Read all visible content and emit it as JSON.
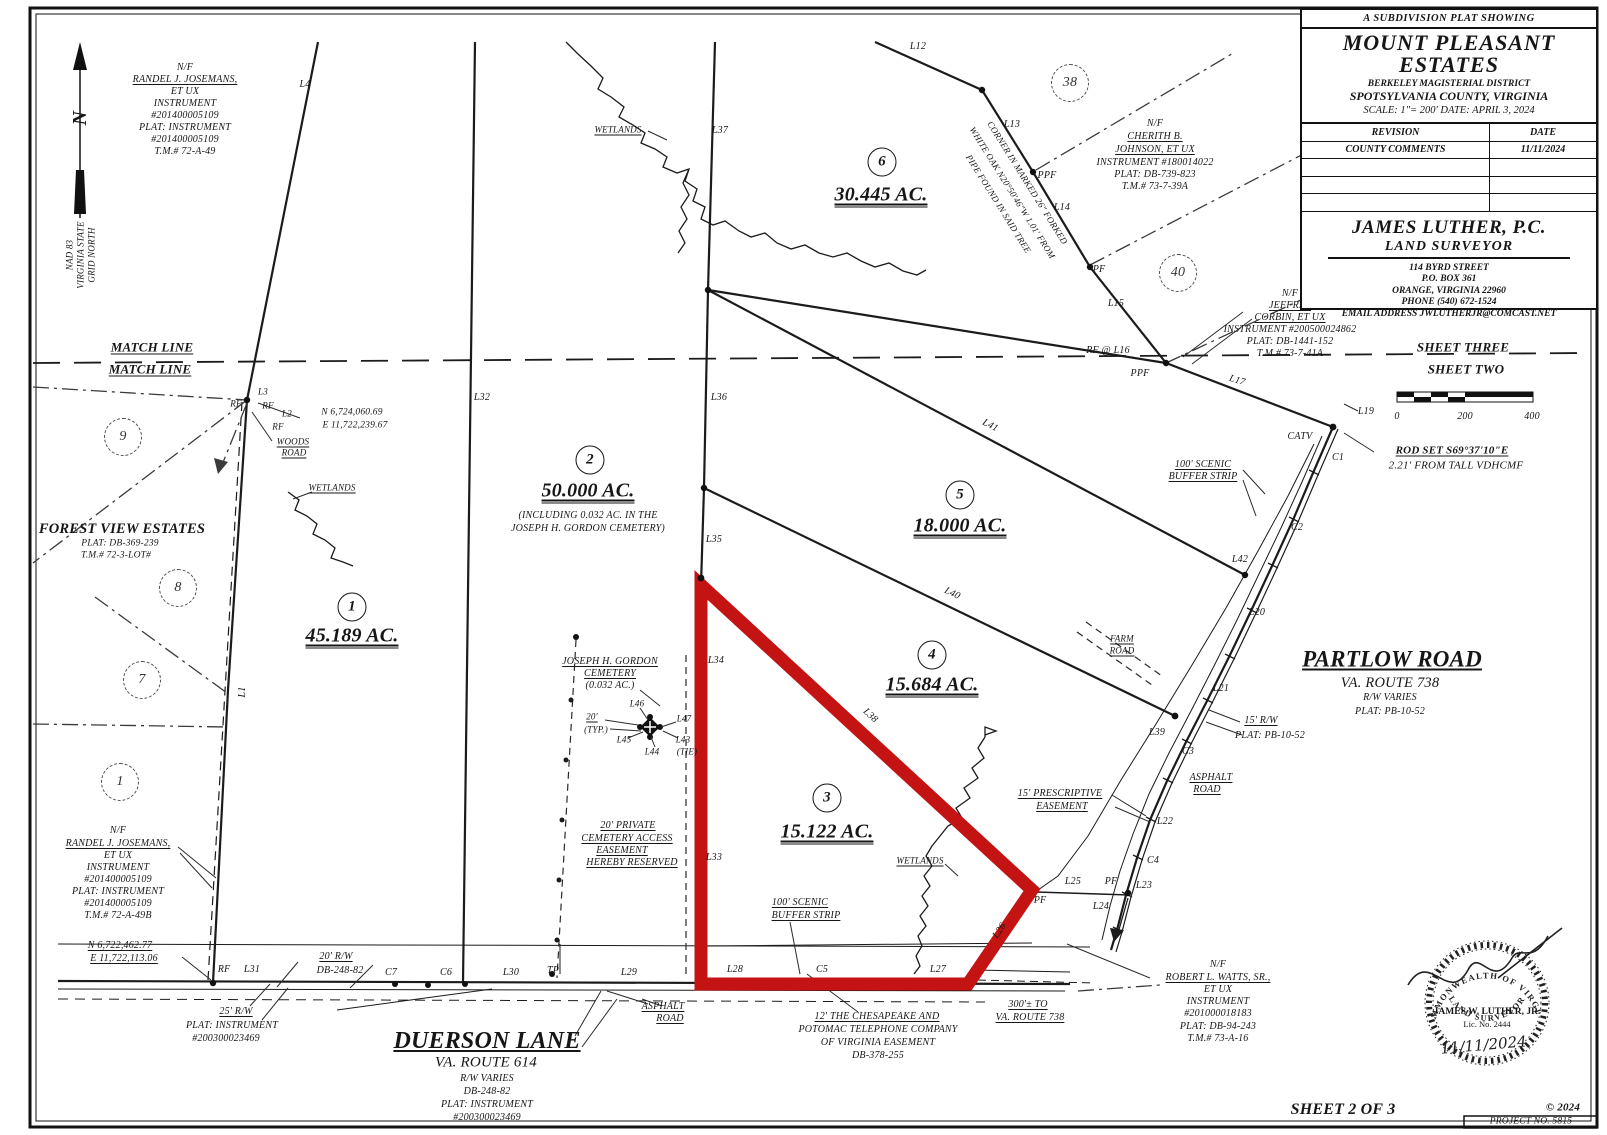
{
  "title_block": {
    "kicker": "A SUBDIVISION PLAT SHOWING",
    "title_line1": "MOUNT PLEASANT",
    "title_line2": "ESTATES",
    "district": "BERKELEY MAGISTERIAL DISTRICT",
    "county": "SPOTSYLVANIA COUNTY, VIRGINIA",
    "scale_date": "SCALE: 1\"= 200'  DATE: APRIL 3, 2024"
  },
  "revision_table": {
    "headers": [
      "REVISION",
      "DATE"
    ],
    "rows": [
      [
        "COUNTY COMMENTS",
        "11/11/2024"
      ],
      [
        "",
        ""
      ],
      [
        "",
        ""
      ],
      [
        "",
        ""
      ]
    ]
  },
  "surveyor_block": {
    "name": "JAMES LUTHER, P.C.",
    "role": "LAND SURVEYOR",
    "address1": "114 BYRD STREET",
    "address2": "P.O. BOX 361",
    "address3": "ORANGE, VIRGINIA 22960",
    "address4": "PHONE (540) 672-1524",
    "email": "EMAIL ADDRESS  JWLUTHERJR@COMCAST.NET"
  },
  "seal": {
    "arc_top": "COMMONWEALTH OF VIRGINIA",
    "name": "JAMES W. LUTHER, JR.",
    "license": "Lic. No. 2444",
    "date": "11/11/2024",
    "arc_bottom": "LAND SURVEYOR"
  },
  "north_arrow": {
    "letter": "N",
    "datum_lines": [
      "NAD 83",
      "VIRGINIA STATE",
      "GRID NORTH"
    ]
  },
  "scale_bar": {
    "tick_labels": [
      "0",
      "200",
      "400"
    ]
  },
  "footer": {
    "sheet": "SHEET 2 OF 3",
    "copyright": "© 2024",
    "project": "PROJECT NO. 5815"
  },
  "colors": {
    "highlight_red": "#c31313",
    "ink": "#1b1b1b",
    "paper": "#ffffff"
  },
  "labels": [
    {
      "t": "N/F",
      "x": 185,
      "y": 68
    },
    {
      "t": "RANDEL J. JOSEMANS,",
      "x": 185,
      "y": 80,
      "c": "u",
      "n": "adjoiner-owner-label"
    },
    {
      "t": "ET UX",
      "x": 185,
      "y": 92
    },
    {
      "t": "INSTRUMENT",
      "x": 185,
      "y": 104
    },
    {
      "t": "#201400005109",
      "x": 185,
      "y": 116
    },
    {
      "t": "PLAT: INSTRUMENT",
      "x": 185,
      "y": 128
    },
    {
      "t": "#201400005109",
      "x": 185,
      "y": 140
    },
    {
      "t": "T.M.# 72-A-49",
      "x": 185,
      "y": 152
    },
    {
      "t": "L4",
      "x": 305,
      "y": 85
    },
    {
      "t": "N",
      "x": 80,
      "y": 118,
      "s": 20,
      "r": -90,
      "c": "b",
      "n": "north-letter"
    },
    {
      "t": "NAD 83",
      "x": 70,
      "y": 255,
      "s": 9,
      "r": -90,
      "n": "datum-label"
    },
    {
      "t": "VIRGINIA STATE",
      "x": 81,
      "y": 255,
      "s": 9,
      "r": -90
    },
    {
      "t": "GRID NORTH",
      "x": 92,
      "y": 255,
      "s": 9,
      "r": -90
    },
    {
      "t": "MATCH LINE",
      "x": 152,
      "y": 347,
      "s": 13,
      "c": "b u",
      "n": "match-line-label"
    },
    {
      "t": "MATCH LINE",
      "x": 150,
      "y": 369,
      "s": 13,
      "c": "b u"
    },
    {
      "t": "SHEET THREE",
      "x": 1463,
      "y": 347,
      "s": 13,
      "c": "b",
      "n": "sheet-three-label"
    },
    {
      "t": "SHEET TWO",
      "x": 1466,
      "y": 369,
      "s": 13,
      "c": "b",
      "n": "sheet-two-label"
    },
    {
      "t": "L3",
      "x": 263,
      "y": 392,
      "s": 9
    },
    {
      "t": "RF",
      "x": 236,
      "y": 404,
      "s": 9
    },
    {
      "t": "RF",
      "x": 268,
      "y": 406,
      "s": 9
    },
    {
      "t": "L2",
      "x": 287,
      "y": 414,
      "s": 9
    },
    {
      "t": "N 6,724,060.69",
      "x": 352,
      "y": 413,
      "s": 9.5,
      "n": "coordinate-label"
    },
    {
      "t": "RF",
      "x": 278,
      "y": 427,
      "s": 9
    },
    {
      "t": "E 11,722,239.67",
      "x": 355,
      "y": 426,
      "s": 9.5
    },
    {
      "t": "WOODS",
      "x": 293,
      "y": 442,
      "s": 9,
      "c": "u"
    },
    {
      "t": "ROAD",
      "x": 294,
      "y": 453,
      "s": 9,
      "c": "u"
    },
    {
      "t": "WETLANDS",
      "x": 332,
      "y": 488,
      "s": 9,
      "c": "u",
      "n": "wetlands-label"
    },
    {
      "t": "FOREST VIEW ESTATES",
      "x": 122,
      "y": 529,
      "s": 14.5,
      "c": "b",
      "n": "adjacent-subdivision-label"
    },
    {
      "t": "PLAT: DB-369-239",
      "x": 120,
      "y": 544,
      "s": 9.5
    },
    {
      "t": "T.M.# 72-3-LOT#",
      "x": 116,
      "y": 556,
      "s": 9.5
    },
    {
      "t": "9",
      "x": 123,
      "y": 437,
      "c": "dcirc",
      "n": "adjacent-lot-number"
    },
    {
      "t": "8",
      "x": 178,
      "y": 588,
      "c": "dcirc",
      "n": "adjacent-lot-number"
    },
    {
      "t": "7",
      "x": 142,
      "y": 680,
      "c": "dcirc",
      "n": "adjacent-lot-number"
    },
    {
      "t": "1",
      "x": 120,
      "y": 782,
      "c": "dcirc",
      "n": "adjacent-lot-number"
    },
    {
      "t": "38",
      "x": 1070,
      "y": 83,
      "c": "dcirc",
      "n": "adjacent-lot-number"
    },
    {
      "t": "40",
      "x": 1178,
      "y": 273,
      "c": "dcirc",
      "n": "adjacent-lot-number"
    },
    {
      "t": "1",
      "x": 352,
      "y": 607,
      "c": "circ",
      "n": "parcel-1-number"
    },
    {
      "t": "45.189 AC.",
      "x": 352,
      "y": 637,
      "s": 20,
      "c": "b uu",
      "n": "parcel-1-acreage"
    },
    {
      "t": "2",
      "x": 590,
      "y": 460,
      "c": "circ",
      "n": "parcel-2-number"
    },
    {
      "t": "50.000 AC.",
      "x": 588,
      "y": 492,
      "s": 20,
      "c": "b uu",
      "n": "parcel-2-acreage"
    },
    {
      "t": "(INCLUDING 0.032 AC. IN THE",
      "x": 588,
      "y": 516
    },
    {
      "t": "JOSEPH H. GORDON CEMETERY)",
      "x": 588,
      "y": 529
    },
    {
      "t": "3",
      "x": 827,
      "y": 798,
      "c": "circ",
      "n": "parcel-3-number"
    },
    {
      "t": "15.122 AC.",
      "x": 827,
      "y": 833,
      "s": 20,
      "c": "b uu",
      "n": "parcel-3-acreage"
    },
    {
      "t": "4",
      "x": 932,
      "y": 655,
      "c": "circ",
      "n": "parcel-4-number"
    },
    {
      "t": "15.684 AC.",
      "x": 932,
      "y": 686,
      "s": 20,
      "c": "b uu",
      "n": "parcel-4-acreage"
    },
    {
      "t": "5",
      "x": 960,
      "y": 495,
      "c": "circ",
      "n": "parcel-5-number"
    },
    {
      "t": "18.000 AC.",
      "x": 960,
      "y": 527,
      "s": 20,
      "c": "b uu",
      "n": "parcel-5-acreage"
    },
    {
      "t": "6",
      "x": 882,
      "y": 162,
      "c": "circ",
      "n": "parcel-6-number"
    },
    {
      "t": "30.445 AC.",
      "x": 881,
      "y": 196,
      "s": 20,
      "c": "b uu",
      "n": "parcel-6-acreage"
    },
    {
      "t": "L32",
      "x": 482,
      "y": 398
    },
    {
      "t": "L36",
      "x": 719,
      "y": 398
    },
    {
      "t": "L37",
      "x": 720,
      "y": 131
    },
    {
      "t": "L35",
      "x": 714,
      "y": 540
    },
    {
      "t": "L34",
      "x": 716,
      "y": 661
    },
    {
      "t": "L33",
      "x": 714,
      "y": 858
    },
    {
      "t": "L12",
      "x": 918,
      "y": 47
    },
    {
      "t": "L13",
      "x": 1012,
      "y": 125
    },
    {
      "t": "PPF",
      "x": 1047,
      "y": 176
    },
    {
      "t": "L14",
      "x": 1062,
      "y": 208
    },
    {
      "t": "PF",
      "x": 1099,
      "y": 270
    },
    {
      "t": "L15",
      "x": 1116,
      "y": 304
    },
    {
      "t": "RF @ L16",
      "x": 1108,
      "y": 351
    },
    {
      "t": "PPF",
      "x": 1140,
      "y": 374
    },
    {
      "t": "L17",
      "x": 1237,
      "y": 381,
      "r": 17
    },
    {
      "t": "L19",
      "x": 1366,
      "y": 412
    },
    {
      "t": "CATV",
      "x": 1300,
      "y": 437
    },
    {
      "t": "C1",
      "x": 1338,
      "y": 458
    },
    {
      "t": "ROD SET S69°37'10\"E",
      "x": 1452,
      "y": 451,
      "s": 11,
      "c": "b u"
    },
    {
      "t": "2.21' FROM TALL VDHCMF",
      "x": 1456,
      "y": 466,
      "s": 11
    },
    {
      "t": "100' SCENIC",
      "x": 1203,
      "y": 465,
      "c": "u",
      "n": "scenic-buffer-label"
    },
    {
      "t": "BUFFER STRIP",
      "x": 1203,
      "y": 477,
      "c": "u"
    },
    {
      "t": "C2",
      "x": 1297,
      "y": 528
    },
    {
      "t": "L42",
      "x": 1240,
      "y": 560
    },
    {
      "t": "L20",
      "x": 1257,
      "y": 613
    },
    {
      "t": "FARM",
      "x": 1122,
      "y": 639,
      "s": 9,
      "c": "u"
    },
    {
      "t": "ROAD",
      "x": 1122,
      "y": 651,
      "s": 9,
      "c": "u"
    },
    {
      "t": "PARTLOW ROAD",
      "x": 1392,
      "y": 659,
      "s": 23,
      "c": "b u",
      "n": "partlow-road-label"
    },
    {
      "t": "VA. ROUTE 738",
      "x": 1390,
      "y": 683,
      "s": 14.5
    },
    {
      "t": "R/W VARIES",
      "x": 1390,
      "y": 698
    },
    {
      "t": "PLAT: PB-10-52",
      "x": 1390,
      "y": 712
    },
    {
      "t": "L21",
      "x": 1221,
      "y": 689
    },
    {
      "t": "15' R/W",
      "x": 1261,
      "y": 721,
      "c": "u"
    },
    {
      "t": "PLAT: PB-10-52",
      "x": 1270,
      "y": 736
    },
    {
      "t": "L39",
      "x": 1157,
      "y": 733
    },
    {
      "t": "C3",
      "x": 1188,
      "y": 752
    },
    {
      "t": "ASPHALT",
      "x": 1211,
      "y": 778,
      "c": "u"
    },
    {
      "t": "ROAD",
      "x": 1207,
      "y": 790,
      "c": "u"
    },
    {
      "t": "15' PRESCRIPTIVE",
      "x": 1060,
      "y": 794,
      "c": "u",
      "n": "prescriptive-easement-label"
    },
    {
      "t": "EASEMENT",
      "x": 1062,
      "y": 807,
      "c": "u"
    },
    {
      "t": "L22",
      "x": 1165,
      "y": 822
    },
    {
      "t": "C4",
      "x": 1153,
      "y": 861
    },
    {
      "t": "L25",
      "x": 1073,
      "y": 882
    },
    {
      "t": "PF",
      "x": 1111,
      "y": 882
    },
    {
      "t": "L23",
      "x": 1144,
      "y": 886
    },
    {
      "t": "L24",
      "x": 1101,
      "y": 907
    },
    {
      "t": "PF",
      "x": 1040,
      "y": 901
    },
    {
      "t": "WETLANDS",
      "x": 920,
      "y": 861,
      "s": 9,
      "c": "u",
      "n": "wetlands-label"
    },
    {
      "t": "100' SCENIC",
      "x": 800,
      "y": 903,
      "c": "u",
      "n": "scenic-buffer-label"
    },
    {
      "t": "BUFFER STRIP",
      "x": 806,
      "y": 916,
      "c": "u"
    },
    {
      "t": "L38",
      "x": 870,
      "y": 716,
      "r": 43
    },
    {
      "t": "L40",
      "x": 952,
      "y": 594,
      "r": 26
    },
    {
      "t": "L41",
      "x": 990,
      "y": 426,
      "r": 28
    },
    {
      "t": "L26",
      "x": 1000,
      "y": 931,
      "r": -56
    },
    {
      "t": "L1",
      "x": 243,
      "y": 692,
      "r": -90
    },
    {
      "t": "JOSEPH H. GORDON",
      "x": 610,
      "y": 662,
      "c": "u",
      "n": "cemetery-label"
    },
    {
      "t": "CEMETERY",
      "x": 610,
      "y": 674,
      "c": "u"
    },
    {
      "t": "(0.032 AC.)",
      "x": 610,
      "y": 686
    },
    {
      "t": "L46",
      "x": 637,
      "y": 704,
      "s": 9
    },
    {
      "t": "20'",
      "x": 592,
      "y": 717,
      "s": 9,
      "c": "u"
    },
    {
      "t": "(TYP.)",
      "x": 596,
      "y": 730,
      "s": 9
    },
    {
      "t": "L47",
      "x": 684,
      "y": 719,
      "s": 9
    },
    {
      "t": "L45",
      "x": 624,
      "y": 740,
      "s": 9
    },
    {
      "t": "L44",
      "x": 652,
      "y": 752,
      "s": 9
    },
    {
      "t": "L43",
      "x": 683,
      "y": 740,
      "s": 9
    },
    {
      "t": "(TIE)",
      "x": 687,
      "y": 752,
      "s": 9
    },
    {
      "t": "20' PRIVATE",
      "x": 628,
      "y": 826,
      "c": "u",
      "n": "cemetery-easement-note"
    },
    {
      "t": "CEMETERY ACCESS",
      "x": 627,
      "y": 839,
      "c": "u"
    },
    {
      "t": "EASEMENT",
      "x": 622,
      "y": 851,
      "c": "u"
    },
    {
      "t": "HEREBY RESERVED",
      "x": 632,
      "y": 863,
      "c": "u"
    },
    {
      "t": "WETLANDS",
      "x": 618,
      "y": 130,
      "s": 9,
      "c": "u",
      "n": "wetlands-label"
    },
    {
      "t": "CORNER IN MARKED 26\" FORKED",
      "x": 1027,
      "y": 183,
      "s": 9,
      "r": 58,
      "n": "corner-note"
    },
    {
      "t": "WHITE OAK N20°50'46\"W 1.01' FROM",
      "x": 1012,
      "y": 193,
      "s": 9,
      "r": 58
    },
    {
      "t": "PIPE FOUND IN SAID TREE",
      "x": 998,
      "y": 204,
      "s": 9,
      "r": 58
    },
    {
      "t": "N/F",
      "x": 1155,
      "y": 124
    },
    {
      "t": "CHERITH B.",
      "x": 1155,
      "y": 137,
      "c": "u",
      "n": "adjoiner-owner-label"
    },
    {
      "t": "JOHNSON, ET UX",
      "x": 1155,
      "y": 150,
      "c": "u"
    },
    {
      "t": "INSTRUMENT #180014022",
      "x": 1155,
      "y": 163
    },
    {
      "t": "PLAT: DB-739-823",
      "x": 1155,
      "y": 175
    },
    {
      "t": "T.M.# 73-7-39A",
      "x": 1155,
      "y": 187
    },
    {
      "t": "N/F",
      "x": 1290,
      "y": 294
    },
    {
      "t": "JEFFREY",
      "x": 1290,
      "y": 306,
      "c": "u",
      "n": "adjoiner-owner-label"
    },
    {
      "t": "CORBIN, ET UX",
      "x": 1290,
      "y": 318,
      "c": "u"
    },
    {
      "t": "INSTRUMENT #200500024862",
      "x": 1290,
      "y": 330
    },
    {
      "t": "PLAT: DB-1441-152",
      "x": 1290,
      "y": 342
    },
    {
      "t": "T.M.# 73-7-41A",
      "x": 1290,
      "y": 354
    },
    {
      "t": "RF",
      "x": 224,
      "y": 970
    },
    {
      "t": "L31",
      "x": 252,
      "y": 970
    },
    {
      "t": "20' R/W",
      "x": 336,
      "y": 957,
      "c": "u"
    },
    {
      "t": "DB-248-82",
      "x": 340,
      "y": 971
    },
    {
      "t": "C7",
      "x": 391,
      "y": 973
    },
    {
      "t": "C6",
      "x": 446,
      "y": 973
    },
    {
      "t": "L30",
      "x": 511,
      "y": 973
    },
    {
      "t": "TP",
      "x": 553,
      "y": 971
    },
    {
      "t": "L29",
      "x": 629,
      "y": 973
    },
    {
      "t": "L28",
      "x": 735,
      "y": 970
    },
    {
      "t": "C5",
      "x": 822,
      "y": 970
    },
    {
      "t": "L27",
      "x": 938,
      "y": 970
    },
    {
      "t": "ASPHALT",
      "x": 663,
      "y": 1007,
      "c": "u"
    },
    {
      "t": "ROAD",
      "x": 670,
      "y": 1019,
      "c": "u"
    },
    {
      "t": "25' R/W",
      "x": 236,
      "y": 1012,
      "c": "u"
    },
    {
      "t": "PLAT: INSTRUMENT",
      "x": 232,
      "y": 1026
    },
    {
      "t": "#200300023469",
      "x": 226,
      "y": 1039
    },
    {
      "t": "N 6,722,462.77",
      "x": 120,
      "y": 946,
      "c": "u",
      "n": "coordinate-label"
    },
    {
      "t": "E 11,722,113.06",
      "x": 124,
      "y": 959,
      "c": "u"
    },
    {
      "t": "N/F",
      "x": 118,
      "y": 831
    },
    {
      "t": "RANDEL J. JOSEMANS,",
      "x": 118,
      "y": 844,
      "c": "u",
      "n": "adjoiner-owner-label"
    },
    {
      "t": "ET UX",
      "x": 118,
      "y": 856
    },
    {
      "t": "INSTRUMENT",
      "x": 118,
      "y": 868
    },
    {
      "t": "#201400005109",
      "x": 118,
      "y": 880
    },
    {
      "t": "PLAT: INSTRUMENT",
      "x": 118,
      "y": 892
    },
    {
      "t": "#201400005109",
      "x": 118,
      "y": 904
    },
    {
      "t": "T.M.# 72-A-49B",
      "x": 118,
      "y": 916
    },
    {
      "t": "DUERSON LANE",
      "x": 487,
      "y": 1041,
      "s": 24,
      "c": "b u",
      "n": "duerson-lane-label"
    },
    {
      "t": "VA. ROUTE 614",
      "x": 486,
      "y": 1063,
      "s": 15
    },
    {
      "t": "R/W VARIES",
      "x": 487,
      "y": 1079
    },
    {
      "t": "DB-248-82",
      "x": 487,
      "y": 1092
    },
    {
      "t": "PLAT: INSTRUMENT",
      "x": 487,
      "y": 1105
    },
    {
      "t": "#200300023469",
      "x": 487,
      "y": 1118
    },
    {
      "t": "12' THE CHESAPEAKE AND",
      "x": 877,
      "y": 1017,
      "c": "u",
      "n": "telephone-easement-note"
    },
    {
      "t": "POTOMAC TELEPHONE COMPANY",
      "x": 878,
      "y": 1030
    },
    {
      "t": "OF VIRGINIA EASEMENT",
      "x": 878,
      "y": 1043
    },
    {
      "t": "DB-378-255",
      "x": 878,
      "y": 1056
    },
    {
      "t": "300'± TO",
      "x": 1028,
      "y": 1005,
      "c": "u"
    },
    {
      "t": "VA. ROUTE 738",
      "x": 1030,
      "y": 1018,
      "c": "u"
    },
    {
      "t": "N/F",
      "x": 1218,
      "y": 965
    },
    {
      "t": "ROBERT L. WATTS, SR.,",
      "x": 1218,
      "y": 978,
      "c": "u",
      "n": "adjoiner-owner-label"
    },
    {
      "t": "ET UX",
      "x": 1218,
      "y": 990
    },
    {
      "t": "INSTRUMENT",
      "x": 1218,
      "y": 1002
    },
    {
      "t": "#201000018183",
      "x": 1218,
      "y": 1014
    },
    {
      "t": "PLAT: DB-94-243",
      "x": 1218,
      "y": 1027
    },
    {
      "t": "T.M.# 73-A-16",
      "x": 1218,
      "y": 1039
    },
    {
      "t": "0",
      "x": 1397,
      "y": 417,
      "n": "scale-tick"
    },
    {
      "t": "200",
      "x": 1465,
      "y": 417,
      "n": "scale-tick"
    },
    {
      "t": "400",
      "x": 1532,
      "y": 417,
      "n": "scale-tick"
    },
    {
      "t": "SHEET 2 OF 3",
      "x": 1343,
      "y": 1110,
      "s": 16,
      "c": "b",
      "n": "sheet-number"
    },
    {
      "t": "© 2024",
      "x": 1563,
      "y": 1108,
      "s": 11,
      "c": "b",
      "n": "copyright"
    },
    {
      "t": "PROJECT NO. 5815",
      "x": 1531,
      "y": 1122,
      "s": 9.5,
      "n": "project-number"
    }
  ]
}
